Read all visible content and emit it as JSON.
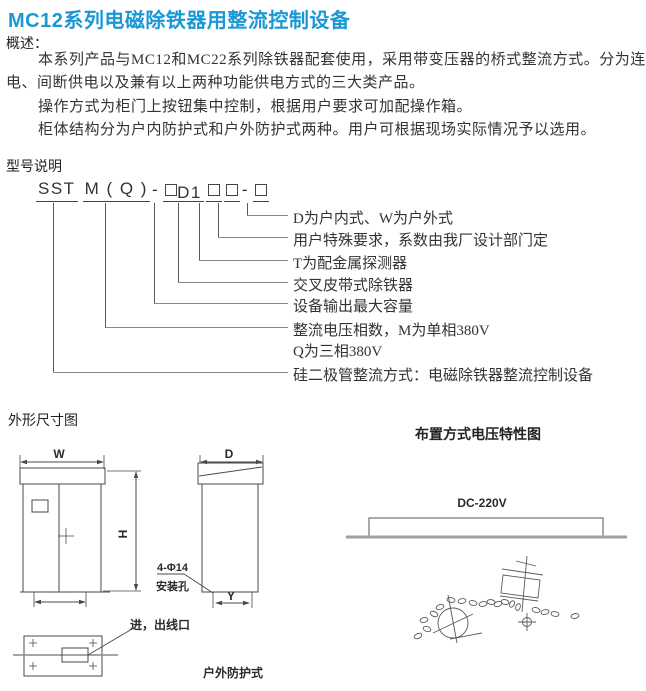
{
  "page": {
    "title": "MC12系列电磁除铁器用整流控制设备"
  },
  "overview": {
    "heading": "概述：",
    "lines": [
      "本系列产品与MC12和MC22系列除铁器配套使用，采用带变压器的桥式整流方式。分为连续供",
      "电、间断供电以及兼有以上两种功能供电方式的三大类产品。",
      "操作方式为柜门上按钮集中控制，根据用户要求可加配操作箱。",
      "柜体结构分为户内防护式和户外防护式两种。用户可根据现场实际情况予以选用。"
    ]
  },
  "model": {
    "heading": "型号说明",
    "code": {
      "sst": "SST",
      "mq": "M ( Q )",
      "dash1": "-",
      "d1": "D1",
      "dash2": "-"
    },
    "callouts": [
      {
        "label": "D为户内式、W为户外式"
      },
      {
        "label": "用户特殊要求，系数由我厂设计部门定"
      },
      {
        "label": "T为配金属探测器"
      },
      {
        "label": "交叉皮带式除铁器"
      },
      {
        "label": "设备输出最大容量"
      },
      {
        "label": "整流电压相数，M为单相380V"
      },
      {
        "label": "Q为三相380V"
      },
      {
        "label": "硅二极管整流方式：电磁除铁器整流控制设备"
      }
    ]
  },
  "dimensions": {
    "heading": "外形尺寸图",
    "labels": {
      "width": "W",
      "height": "H",
      "depth": "D",
      "foot": "Y"
    },
    "mount_hole_line1": "4-Φ14",
    "mount_hole_line2": "安装孔",
    "inlet_label": "进，出线口",
    "outdoor_label": "户外防护式"
  },
  "layout_diagram": {
    "heading": "布置方式电压特性图",
    "voltage_label": "DC-220V"
  },
  "colors": {
    "title_blue": "#1a98d5",
    "text": "#333333",
    "line": "#555555",
    "ground": "#a0a0a0"
  }
}
